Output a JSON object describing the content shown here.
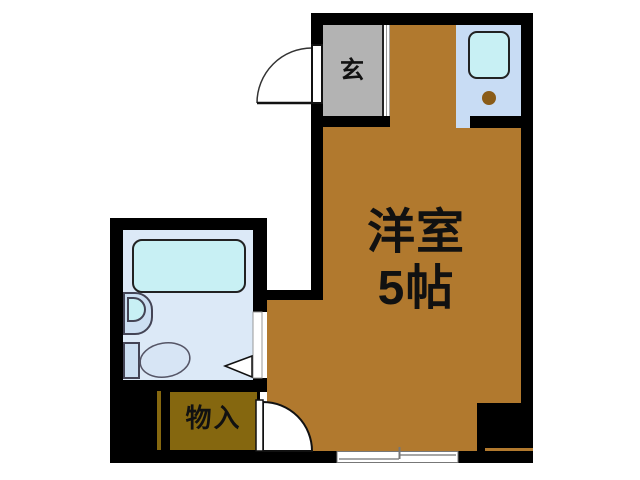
{
  "floorplan": {
    "rooms": {
      "entrance": {
        "label": "玄"
      },
      "main_room": {
        "label_line1": "洋室",
        "label_line2": "5帖"
      },
      "storage": {
        "label": "物入"
      }
    },
    "colors": {
      "wall": "#000000",
      "main_room_floor": "#b1792e",
      "entrance_floor": "#b3b3b3",
      "kitchen_counter": "#c8dcf4",
      "fixture_cyan": "#c8f0f4",
      "bathroom_floor": "#dce9f7",
      "fixture_light": "#ccdff2",
      "storage_fill": "#85670f",
      "burner_brown": "#8a5c18",
      "label_text": "#111111"
    }
  }
}
